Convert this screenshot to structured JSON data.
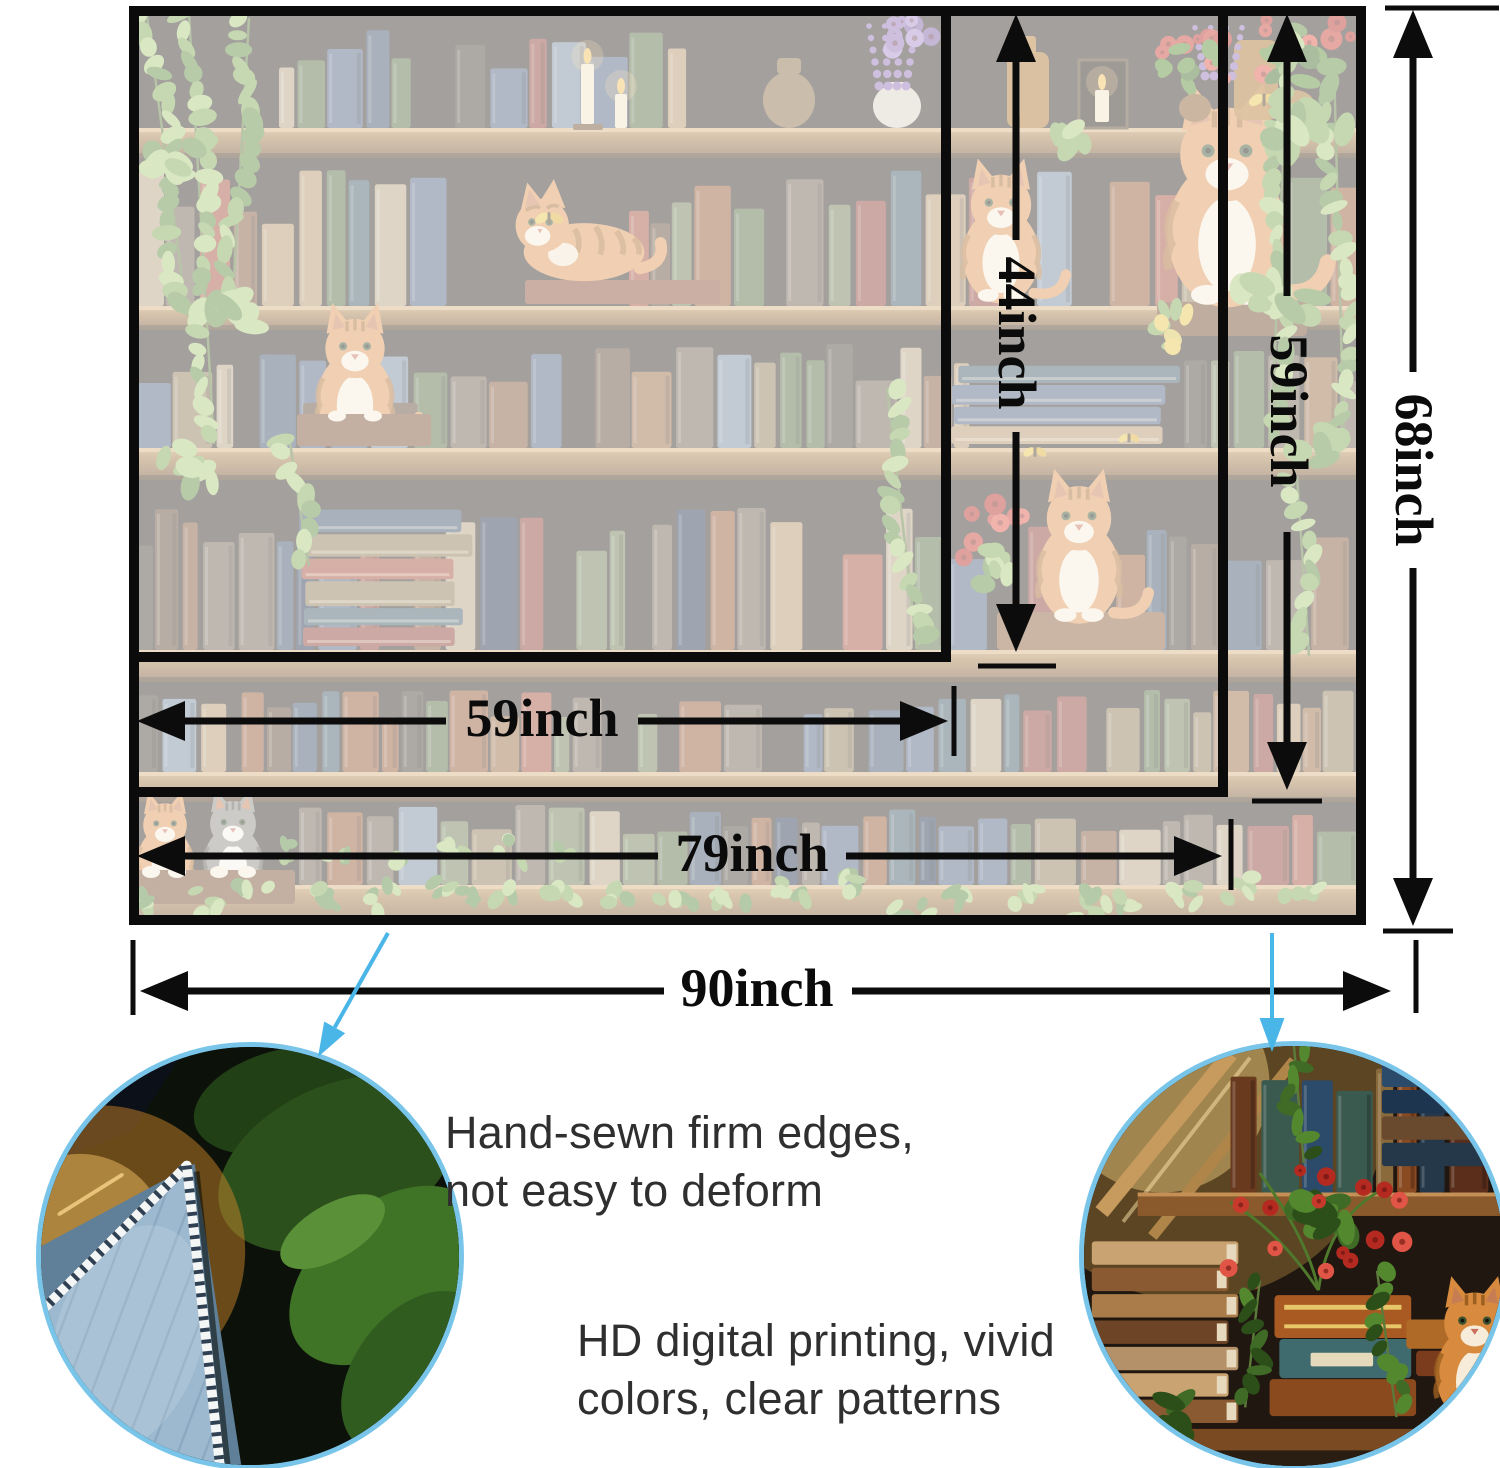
{
  "labels": {
    "small_height": "44inch",
    "medium_height": "59inch",
    "large_height": "68inch",
    "small_width": "59inch",
    "medium_width": "79inch",
    "large_width": "90inch"
  },
  "callouts": {
    "left": {
      "line1": "Hand-sewn firm edges,",
      "line2": "not easy to deform"
    },
    "right": {
      "line1": "HD digital printing, vivid",
      "line2": "colors, clear patterns"
    }
  },
  "colors": {
    "ink": "#0c0c0c",
    "pointer_blue": "#4ab6e8",
    "circle_border_blue": "#79c5ea",
    "text_dark": "#2f2f2f",
    "scene_backdrop": "#372e26",
    "row_back": "#2e2720",
    "wood_light": "#c29a64",
    "wood_mid": "#a47a46",
    "wood_dark": "#6e4b28",
    "cat_orange": "#dd9350",
    "cat_stripe": "#a96a2c",
    "cat_cream": "#f6ecd9",
    "gray_cat": "#8e8a80",
    "gray_cat_stripe": "#55524a",
    "leaf_light": "#a8c878",
    "leaf_green": "#7da74f",
    "leaf_dark": "#5e8a3c",
    "ivy_deep": "#56863a",
    "flower_red": "#c63a2c",
    "flower_red2": "#e05545",
    "flower_deep": "#b52a20",
    "flower_purple": "#8f6fb5",
    "butterfly_yellow": "#e9c448",
    "fabric_blue": "#9db9cf",
    "fabric_blue_dark": "#5f8098",
    "stitch_white": "#f4f6f6",
    "stitch_dash": "#2e4052",
    "wash_white": "#ffffff",
    "book_palette": [
      "#7d5233",
      "#5f4630",
      "#94663d",
      "#4e5f7d",
      "#3c4f66",
      "#74879b",
      "#8c3b30",
      "#a34a36",
      "#6b7a4e",
      "#55683f",
      "#8d7852",
      "#b29267",
      "#463b31",
      "#6f5e4d",
      "#925430",
      "#3f5a64",
      "#22334b",
      "#b5a07f"
    ],
    "vivid_book_palette": [
      "#2c4a6a",
      "#1e3550",
      "#6a3a1f",
      "#8a4a22",
      "#3a5a50",
      "#24384a",
      "#5a2e1a",
      "#a05a28",
      "#8a6a3a",
      "#4a3424"
    ]
  }
}
